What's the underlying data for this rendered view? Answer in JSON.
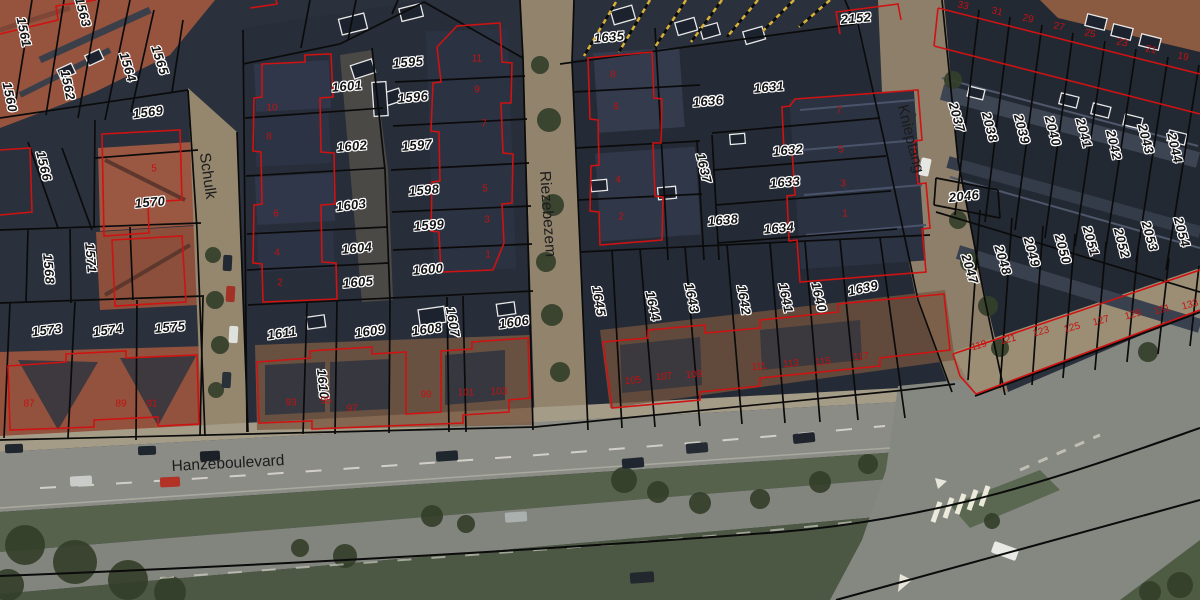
{
  "map": {
    "type": "aerial-cadastral",
    "colors": {
      "parcel_line": "#0b0b0b",
      "building_outline": "#cf1212",
      "parcel_text": "#141414",
      "house_number_text": "#c41111",
      "street_text": "#1c1c1c",
      "hatch_yellow": "#d8b13a"
    },
    "street_labels": [
      {
        "name": "Schulk",
        "x": 207,
        "y": 176,
        "rot": 82
      },
      {
        "name": "Riezebezem",
        "x": 547,
        "y": 214,
        "rot": 86
      },
      {
        "name": "Knieptang",
        "x": 910,
        "y": 139,
        "rot": 76
      },
      {
        "name": "Hanzeboulevard",
        "x": 228,
        "y": 464,
        "rot": -3
      }
    ],
    "parcel_labels": [
      {
        "t": "1560",
        "x": 10,
        "y": 97,
        "rot": 78
      },
      {
        "t": "1561",
        "x": 24,
        "y": 32,
        "rot": 78
      },
      {
        "t": "1562",
        "x": 68,
        "y": 85,
        "rot": 78
      },
      {
        "t": "1563",
        "x": 83,
        "y": 12,
        "rot": 75
      },
      {
        "t": "1564",
        "x": 128,
        "y": 67,
        "rot": 73
      },
      {
        "t": "1565",
        "x": 160,
        "y": 60,
        "rot": 72
      },
      {
        "t": "1566",
        "x": 44,
        "y": 166,
        "rot": 76
      },
      {
        "t": "1569",
        "x": 148,
        "y": 112,
        "rot": -7
      },
      {
        "t": "1570",
        "x": 150,
        "y": 202,
        "rot": -5
      },
      {
        "t": "1568",
        "x": 49,
        "y": 269,
        "rot": 85
      },
      {
        "t": "1571",
        "x": 91,
        "y": 258,
        "rot": 85
      },
      {
        "t": "1573",
        "x": 47,
        "y": 330,
        "rot": -7
      },
      {
        "t": "1574",
        "x": 108,
        "y": 330,
        "rot": -7
      },
      {
        "t": "1575",
        "x": 170,
        "y": 327,
        "rot": -5
      },
      {
        "t": "1595",
        "x": 408,
        "y": 62,
        "rot": -5
      },
      {
        "t": "1596",
        "x": 413,
        "y": 97,
        "rot": -5
      },
      {
        "t": "1597",
        "x": 417,
        "y": 145,
        "rot": -5
      },
      {
        "t": "1598",
        "x": 424,
        "y": 190,
        "rot": -5
      },
      {
        "t": "1599",
        "x": 429,
        "y": 225,
        "rot": -5
      },
      {
        "t": "1600",
        "x": 428,
        "y": 269,
        "rot": -5
      },
      {
        "t": "1601",
        "x": 347,
        "y": 86,
        "rot": -5
      },
      {
        "t": "1602",
        "x": 352,
        "y": 146,
        "rot": -5
      },
      {
        "t": "1603",
        "x": 351,
        "y": 205,
        "rot": -7
      },
      {
        "t": "1604",
        "x": 357,
        "y": 248,
        "rot": -5
      },
      {
        "t": "1605",
        "x": 358,
        "y": 282,
        "rot": -5
      },
      {
        "t": "1606",
        "x": 514,
        "y": 322,
        "rot": -8
      },
      {
        "t": "1607",
        "x": 453,
        "y": 322,
        "rot": 80
      },
      {
        "t": "1608",
        "x": 427,
        "y": 329,
        "rot": -8
      },
      {
        "t": "1609",
        "x": 370,
        "y": 331,
        "rot": -8
      },
      {
        "t": "1610",
        "x": 323,
        "y": 384,
        "rot": 84
      },
      {
        "t": "1611",
        "x": 282,
        "y": 333,
        "rot": -8
      },
      {
        "t": "1635",
        "x": 609,
        "y": 37,
        "rot": -5
      },
      {
        "t": "1636",
        "x": 708,
        "y": 101,
        "rot": -5
      },
      {
        "t": "1631",
        "x": 769,
        "y": 87,
        "rot": -5
      },
      {
        "t": "1632",
        "x": 788,
        "y": 150,
        "rot": -5
      },
      {
        "t": "1633",
        "x": 785,
        "y": 182,
        "rot": -5
      },
      {
        "t": "1634",
        "x": 779,
        "y": 228,
        "rot": -5
      },
      {
        "t": "1637",
        "x": 704,
        "y": 168,
        "rot": 76
      },
      {
        "t": "1638",
        "x": 723,
        "y": 220,
        "rot": -5
      },
      {
        "t": "2152",
        "x": 856,
        "y": 18,
        "rot": -5
      },
      {
        "t": "1645",
        "x": 599,
        "y": 301,
        "rot": 80
      },
      {
        "t": "1644",
        "x": 653,
        "y": 306,
        "rot": 78
      },
      {
        "t": "1643",
        "x": 692,
        "y": 298,
        "rot": 78
      },
      {
        "t": "1642",
        "x": 744,
        "y": 300,
        "rot": 80
      },
      {
        "t": "1641",
        "x": 786,
        "y": 298,
        "rot": 78
      },
      {
        "t": "1640",
        "x": 819,
        "y": 297,
        "rot": 76
      },
      {
        "t": "1639",
        "x": 863,
        "y": 288,
        "rot": -12
      },
      {
        "t": "2037",
        "x": 957,
        "y": 117,
        "rot": 74
      },
      {
        "t": "2038",
        "x": 990,
        "y": 127,
        "rot": 75
      },
      {
        "t": "2039",
        "x": 1022,
        "y": 129,
        "rot": 75
      },
      {
        "t": "2040",
        "x": 1053,
        "y": 131,
        "rot": 75
      },
      {
        "t": "2041",
        "x": 1084,
        "y": 133,
        "rot": 75
      },
      {
        "t": "2042",
        "x": 1114,
        "y": 145,
        "rot": 77
      },
      {
        "t": "2043",
        "x": 1146,
        "y": 139,
        "rot": 75
      },
      {
        "t": "2044",
        "x": 1175,
        "y": 148,
        "rot": 77
      },
      {
        "t": "2046",
        "x": 964,
        "y": 196,
        "rot": -6
      },
      {
        "t": "2047",
        "x": 970,
        "y": 269,
        "rot": 73
      },
      {
        "t": "2048",
        "x": 1003,
        "y": 260,
        "rot": 73
      },
      {
        "t": "2049",
        "x": 1032,
        "y": 252,
        "rot": 74
      },
      {
        "t": "2050",
        "x": 1063,
        "y": 249,
        "rot": 74
      },
      {
        "t": "2051",
        "x": 1091,
        "y": 241,
        "rot": 74
      },
      {
        "t": "2052",
        "x": 1122,
        "y": 243,
        "rot": 75
      },
      {
        "t": "2053",
        "x": 1150,
        "y": 236,
        "rot": 74
      },
      {
        "t": "2054",
        "x": 1182,
        "y": 232,
        "rot": 75
      }
    ],
    "house_number_labels": [
      {
        "t": "5",
        "x": 154,
        "y": 169,
        "rot": 0
      },
      {
        "t": "87",
        "x": 29,
        "y": 404,
        "rot": 0
      },
      {
        "t": "89",
        "x": 121,
        "y": 404,
        "rot": 0
      },
      {
        "t": "91",
        "x": 152,
        "y": 404,
        "rot": 0
      },
      {
        "t": "10",
        "x": 272,
        "y": 108,
        "rot": 0
      },
      {
        "t": "8",
        "x": 269,
        "y": 137,
        "rot": 0
      },
      {
        "t": "6",
        "x": 276,
        "y": 214,
        "rot": 0
      },
      {
        "t": "4",
        "x": 277,
        "y": 253,
        "rot": 0
      },
      {
        "t": "2",
        "x": 280,
        "y": 283,
        "rot": 0
      },
      {
        "t": "11",
        "x": 477,
        "y": 59,
        "rot": 0
      },
      {
        "t": "9",
        "x": 477,
        "y": 90,
        "rot": 0
      },
      {
        "t": "7",
        "x": 484,
        "y": 124,
        "rot": 0
      },
      {
        "t": "5",
        "x": 485,
        "y": 189,
        "rot": 0
      },
      {
        "t": "3",
        "x": 487,
        "y": 220,
        "rot": 0
      },
      {
        "t": "1",
        "x": 488,
        "y": 255,
        "rot": 0
      },
      {
        "t": "93",
        "x": 291,
        "y": 403,
        "rot": 0
      },
      {
        "t": "95",
        "x": 326,
        "y": 401,
        "rot": 0
      },
      {
        "t": "97",
        "x": 352,
        "y": 409,
        "rot": 0
      },
      {
        "t": "99",
        "x": 426,
        "y": 395,
        "rot": 0
      },
      {
        "t": "101",
        "x": 466,
        "y": 393,
        "rot": 0
      },
      {
        "t": "103",
        "x": 499,
        "y": 392,
        "rot": 0
      },
      {
        "t": "8",
        "x": 613,
        "y": 75,
        "rot": 0
      },
      {
        "t": "6",
        "x": 616,
        "y": 107,
        "rot": 0
      },
      {
        "t": "4",
        "x": 618,
        "y": 180,
        "rot": 0
      },
      {
        "t": "2",
        "x": 621,
        "y": 217,
        "rot": 0
      },
      {
        "t": "7",
        "x": 839,
        "y": 111,
        "rot": 0
      },
      {
        "t": "5",
        "x": 841,
        "y": 150,
        "rot": 0
      },
      {
        "t": "3",
        "x": 843,
        "y": 184,
        "rot": 0
      },
      {
        "t": "1",
        "x": 845,
        "y": 214,
        "rot": 0
      },
      {
        "t": "105",
        "x": 633,
        "y": 381,
        "rot": -6
      },
      {
        "t": "107",
        "x": 664,
        "y": 377,
        "rot": -6
      },
      {
        "t": "109",
        "x": 694,
        "y": 375,
        "rot": -6
      },
      {
        "t": "111",
        "x": 759,
        "y": 367,
        "rot": -6
      },
      {
        "t": "113",
        "x": 791,
        "y": 364,
        "rot": -6
      },
      {
        "t": "115",
        "x": 823,
        "y": 362,
        "rot": -6
      },
      {
        "t": "117",
        "x": 861,
        "y": 357,
        "rot": -6
      },
      {
        "t": "33",
        "x": 963,
        "y": 6,
        "rot": 12
      },
      {
        "t": "31",
        "x": 997,
        "y": 12,
        "rot": 12
      },
      {
        "t": "29",
        "x": 1028,
        "y": 19,
        "rot": 12
      },
      {
        "t": "27",
        "x": 1059,
        "y": 27,
        "rot": 12
      },
      {
        "t": "25",
        "x": 1090,
        "y": 34,
        "rot": 12
      },
      {
        "t": "23",
        "x": 1122,
        "y": 43,
        "rot": 12
      },
      {
        "t": "21",
        "x": 1151,
        "y": 50,
        "rot": 12
      },
      {
        "t": "19",
        "x": 1183,
        "y": 57,
        "rot": 12
      },
      {
        "t": "119",
        "x": 979,
        "y": 346,
        "rot": -15
      },
      {
        "t": "121",
        "x": 1008,
        "y": 340,
        "rot": -15
      },
      {
        "t": "123",
        "x": 1041,
        "y": 332,
        "rot": -15
      },
      {
        "t": "125",
        "x": 1072,
        "y": 328,
        "rot": -15
      },
      {
        "t": "127",
        "x": 1101,
        "y": 321,
        "rot": -15
      },
      {
        "t": "129",
        "x": 1133,
        "y": 315,
        "rot": -15
      },
      {
        "t": "131",
        "x": 1162,
        "y": 310,
        "rot": -15
      },
      {
        "t": "133",
        "x": 1190,
        "y": 305,
        "rot": -15
      }
    ]
  }
}
